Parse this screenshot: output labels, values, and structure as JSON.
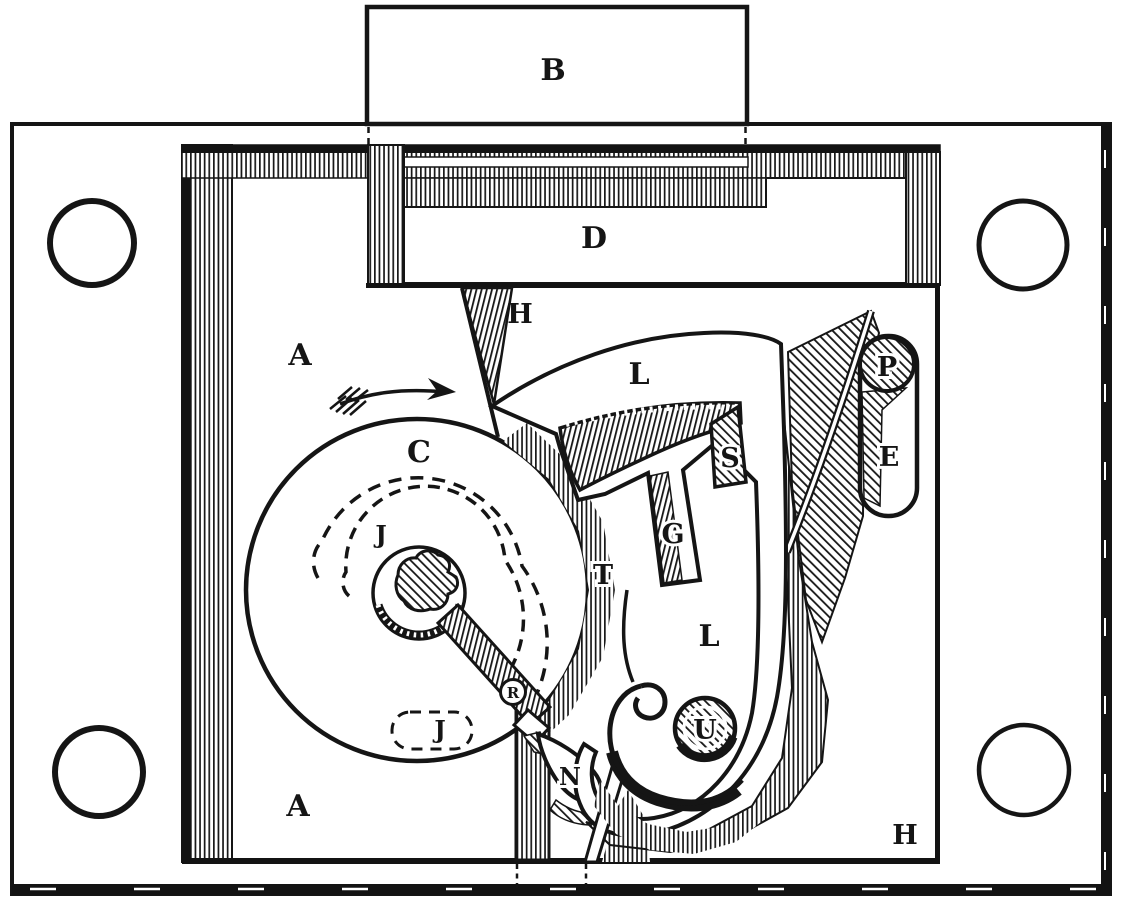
{
  "figure": {
    "type": "technical-engraving",
    "subject": "lock mechanism interior diagram",
    "colors": {
      "ink": "#151515",
      "paper": "#ffffff"
    },
    "labels": [
      {
        "id": "bolt",
        "text": "B"
      },
      {
        "id": "bolt-tail",
        "text": "D"
      },
      {
        "id": "case-upper",
        "text": "A"
      },
      {
        "id": "case-lower",
        "text": "A"
      },
      {
        "id": "stop-upper",
        "text": "H"
      },
      {
        "id": "stop-lower",
        "text": "H"
      },
      {
        "id": "wheel",
        "text": "C"
      },
      {
        "id": "groove-upper",
        "text": "J"
      },
      {
        "id": "groove-lower",
        "text": "J"
      },
      {
        "id": "tooth",
        "text": "T"
      },
      {
        "id": "lever-upper",
        "text": "L"
      },
      {
        "id": "lever-lower",
        "text": "L"
      },
      {
        "id": "slide",
        "text": "S"
      },
      {
        "id": "gate",
        "text": "G"
      },
      {
        "id": "roller",
        "text": "R"
      },
      {
        "id": "notch",
        "text": "N"
      },
      {
        "id": "stud",
        "text": "U"
      },
      {
        "id": "spring",
        "text": "E"
      },
      {
        "id": "pin",
        "text": "P"
      }
    ],
    "annotations": {
      "rotation-arrow": "clockwise rotation of wheel C"
    }
  }
}
